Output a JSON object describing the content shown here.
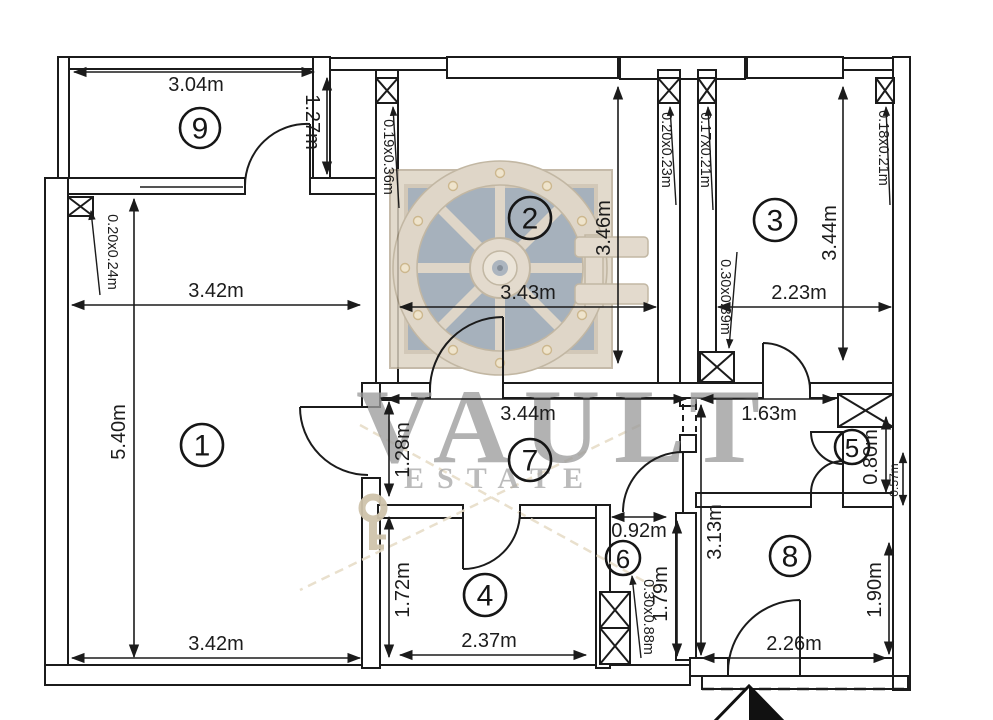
{
  "watermark": {
    "line1": "VAULT",
    "line2": "ESTATE"
  },
  "icons": {
    "entrance_arrow": "entrance-direction-arrow",
    "logo": "vault-door-logo",
    "key": "key-watermark"
  },
  "rooms": [
    {
      "number": "1",
      "dim_top": "3.42m",
      "dim_left": "5.40m",
      "dim_bottom": "3.42m",
      "window": "0.20x0.24m"
    },
    {
      "number": "2",
      "dim_width": "3.43m",
      "dim_height": "3.46m",
      "window_left": "0.19x0.36m",
      "window_right": "0.20x0.23m"
    },
    {
      "number": "3",
      "dim_width": "2.23m",
      "dim_height": "3.44m",
      "window_left": "0.17x0.21m",
      "window_right": "0.18x0.21m",
      "window_bottom": "0.30x0.39m"
    },
    {
      "number": "4",
      "dim_width": "2.37m",
      "dim_height": "1.72m"
    },
    {
      "number": "5",
      "dim_width": "1.63m",
      "dim_height": "0.80m",
      "dim_depth": "0.57m"
    },
    {
      "number": "6",
      "dim_width": "0.92m",
      "dim_height": "1.79m",
      "window": "0.30x0.88m"
    },
    {
      "number": "7",
      "dim_width": "3.44m",
      "dim_height": "1.28m"
    },
    {
      "number": "8",
      "dim_height_left": "3.13m",
      "dim_height_right": "1.90m",
      "dim_width": "2.26m"
    },
    {
      "number": "9",
      "dim_width": "3.04m",
      "dim_height": "1.27m"
    }
  ]
}
